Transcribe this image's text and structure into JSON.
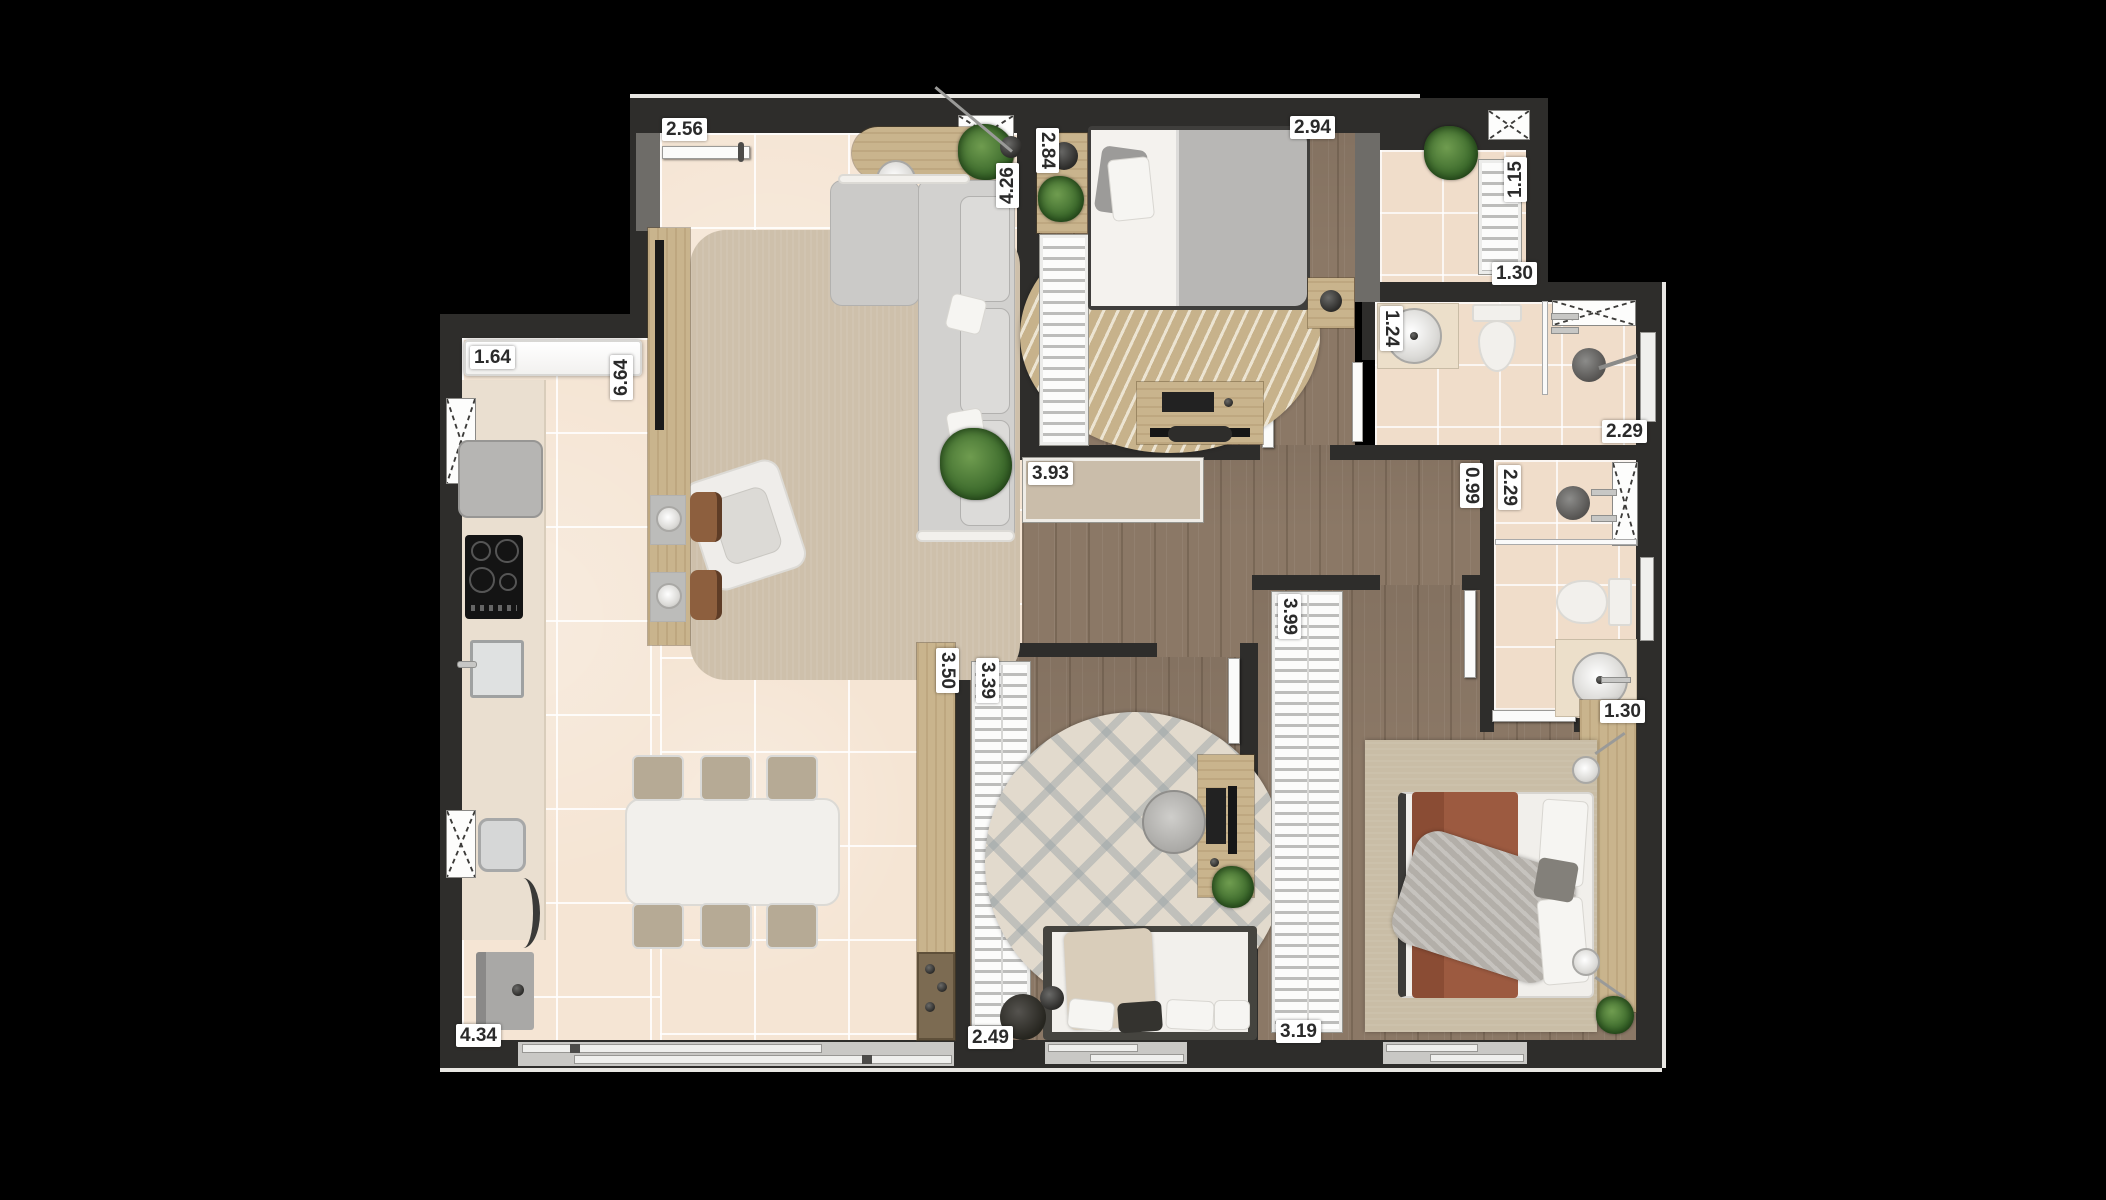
{
  "floor_plan": {
    "type": "apartment-floor-plan-top-view",
    "dimension_labels": [
      {
        "text": "2.56",
        "x": 662,
        "y": 118,
        "orient": "h"
      },
      {
        "text": "2.84",
        "x": 1036,
        "y": 128,
        "orient": "vcw"
      },
      {
        "text": "2.94",
        "x": 1290,
        "y": 116,
        "orient": "h"
      },
      {
        "text": "4.26",
        "x": 996,
        "y": 158,
        "orient": "vccw"
      },
      {
        "text": "1.15",
        "x": 1504,
        "y": 152,
        "orient": "vccw"
      },
      {
        "text": "1.30",
        "x": 1492,
        "y": 262,
        "orient": "h"
      },
      {
        "text": "1.64",
        "x": 470,
        "y": 346,
        "orient": "h"
      },
      {
        "text": "6.64",
        "x": 610,
        "y": 350,
        "orient": "vccw"
      },
      {
        "text": "1.24",
        "x": 1380,
        "y": 306,
        "orient": "vcw"
      },
      {
        "text": "2.29",
        "x": 1602,
        "y": 420,
        "orient": "h"
      },
      {
        "text": "0.99",
        "x": 1460,
        "y": 463,
        "orient": "vcw"
      },
      {
        "text": "2.29",
        "x": 1498,
        "y": 465,
        "orient": "vcw"
      },
      {
        "text": "3.93",
        "x": 1028,
        "y": 462,
        "orient": "h"
      },
      {
        "text": "3.50",
        "x": 936,
        "y": 648,
        "orient": "vcw"
      },
      {
        "text": "3.39",
        "x": 976,
        "y": 658,
        "orient": "vcw"
      },
      {
        "text": "3.99",
        "x": 1278,
        "y": 594,
        "orient": "vcw"
      },
      {
        "text": "1.30",
        "x": 1600,
        "y": 700,
        "orient": "h"
      },
      {
        "text": "4.34",
        "x": 456,
        "y": 1024,
        "orient": "h"
      },
      {
        "text": "2.49",
        "x": 968,
        "y": 1026,
        "orient": "h"
      },
      {
        "text": "3.19",
        "x": 1276,
        "y": 1020,
        "orient": "h"
      }
    ],
    "colors": {
      "background": "#000000",
      "wall": "#2e2d2b",
      "tile_floor": "#f5e5d4",
      "bath_tile": "#f0ddca",
      "wood_floor": "#8b7866",
      "furniture_wood": "#c9b48d",
      "rust_blanket": "#9c5a40",
      "plant_green": "#3c6a2c",
      "label_bg": "#ffffff",
      "label_text": "#2a2a2a"
    }
  }
}
